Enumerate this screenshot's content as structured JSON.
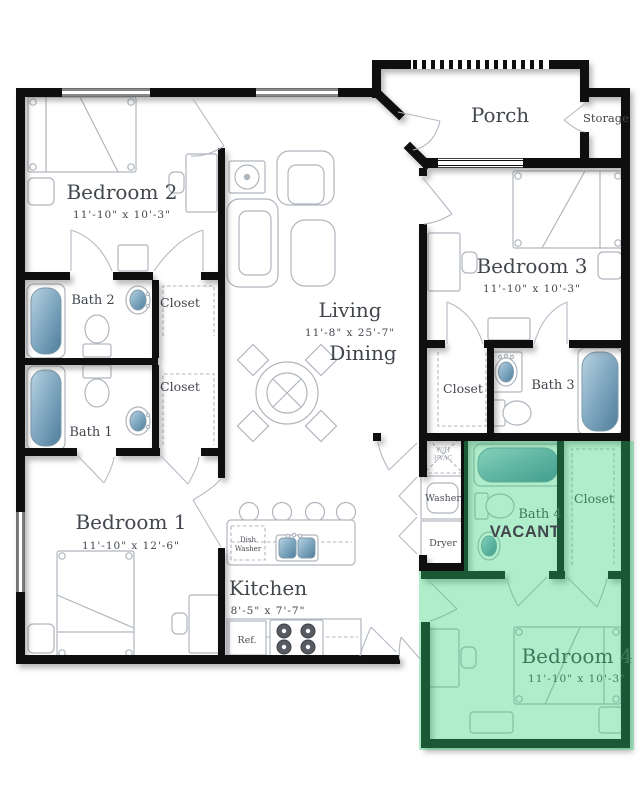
{
  "floorplan": {
    "rooms": {
      "bedroom2": {
        "name": "Bedroom 2",
        "dims": "11'-10\" x 10'-3\""
      },
      "bedroom3": {
        "name": "Bedroom 3",
        "dims": "11'-10\" x 10'-3\""
      },
      "bedroom1": {
        "name": "Bedroom 1",
        "dims": "11'-10\" x 12'-6\""
      },
      "bedroom4": {
        "name": "Bedroom 4",
        "dims": "11'-10\" x 10'-3\""
      },
      "living": {
        "name": "Living",
        "dims": "11'-8\" x 25'-7\"",
        "name2": "Dining"
      },
      "kitchen": {
        "name": "Kitchen",
        "dims": "8'-5\" x 7'-7\""
      },
      "porch": {
        "name": "Porch"
      },
      "storage": {
        "name": "Storage"
      },
      "bath1": {
        "name": "Bath 1"
      },
      "bath2": {
        "name": "Bath 2"
      },
      "bath3": {
        "name": "Bath 3"
      },
      "bath4": {
        "name": "Bath 4"
      },
      "closet_bed2": {
        "name": "Closet"
      },
      "closet_hall": {
        "name": "Closet"
      },
      "closet_bed3": {
        "name": "Closet"
      },
      "closet_bed4": {
        "name": "Closet"
      }
    },
    "fixtures": {
      "washer": "Washer",
      "dryer": "Dryer",
      "dishwasher_line1": "Dish",
      "dishwasher_line2": "Washer",
      "fridge": "Ref.",
      "hvac_line1": "W/H",
      "hvac_line2": "HVAC"
    },
    "status": {
      "vacant_label": "VACANT"
    },
    "colors": {
      "vacant_highlight": "#2fd077",
      "vacant_text": "#dd1414",
      "wall": "#0f0f0f",
      "fixture_blue": "#6f9ab5"
    }
  }
}
